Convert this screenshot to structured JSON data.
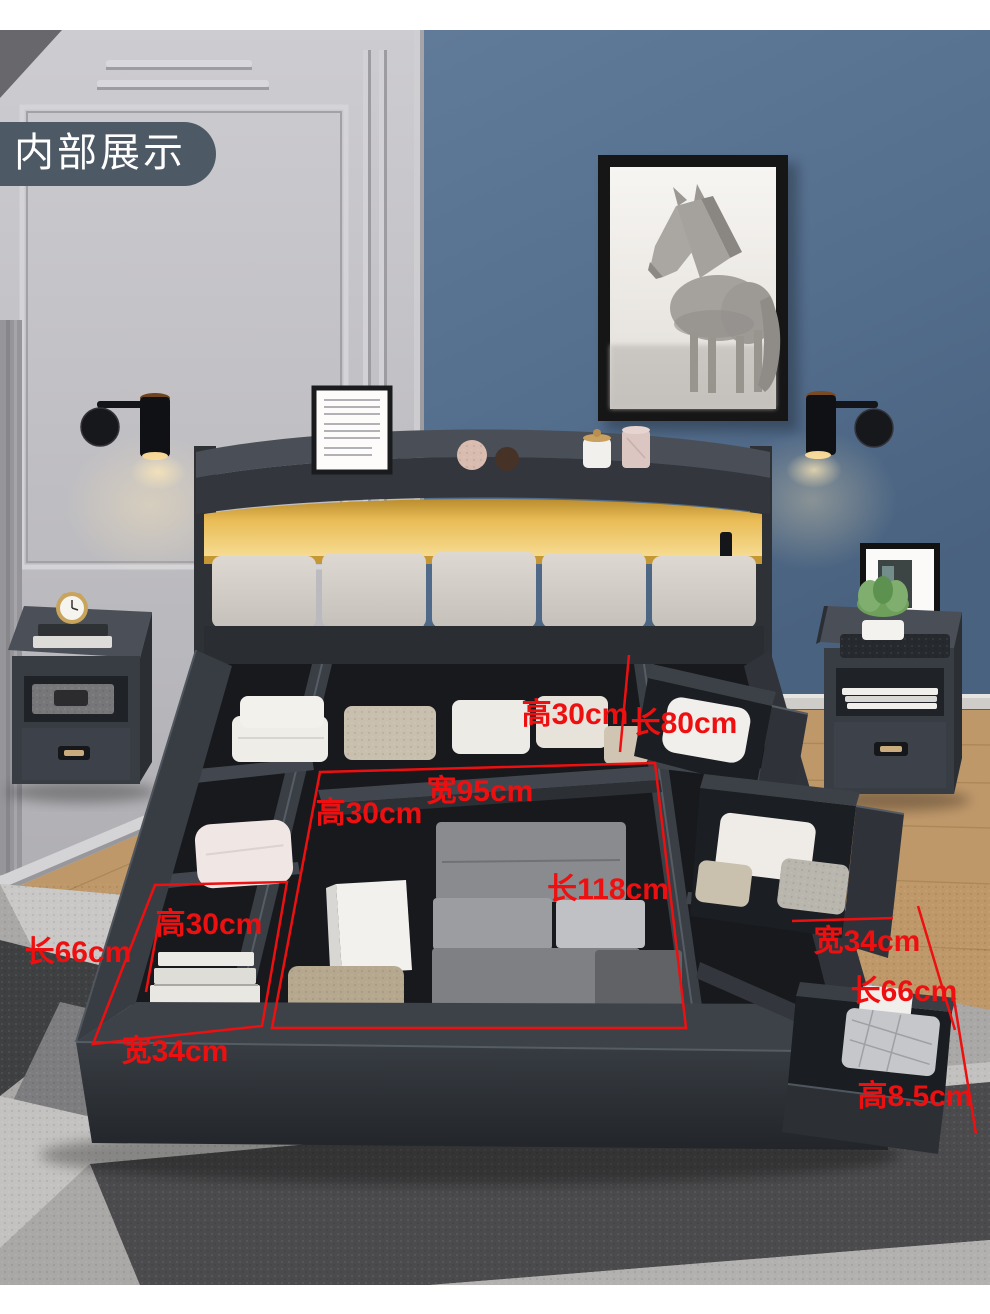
{
  "badge": {
    "label": "内部展示"
  },
  "artwork_subject": "horse",
  "dimension_labels": [
    {
      "text": "高30cm"
    },
    {
      "text": "长80cm"
    },
    {
      "text": "宽95cm"
    },
    {
      "text": "高30cm"
    },
    {
      "text": "长118cm"
    },
    {
      "text": "高30cm"
    },
    {
      "text": "长66cm"
    },
    {
      "text": "宽34cm"
    },
    {
      "text": "长66cm"
    },
    {
      "text": "宽34cm"
    },
    {
      "text": "高8.5cm"
    }
  ],
  "colors": {
    "annotation_red": "#ee1010",
    "badge_bg": "#4d5964",
    "wall_blue": "#53698a",
    "wall_gray": "#c2c1c5",
    "bed_dark": "#33383e",
    "led_glow": "#e9bb55",
    "cushion": "#d7d1cb",
    "wood_floor": "#c29b6e",
    "rug_dark": "#4b4b4d"
  }
}
